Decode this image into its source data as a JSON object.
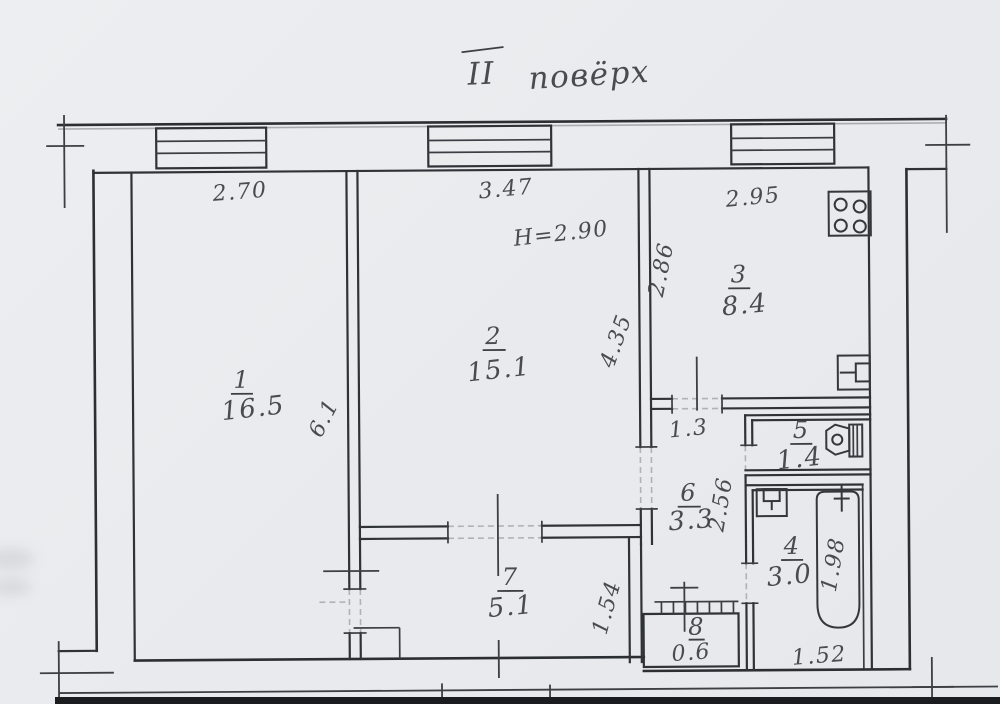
{
  "page": {
    "title_numeral": "ІІ",
    "title_word": "повёрх"
  },
  "rooms": {
    "r1": {
      "num": "1",
      "area": "16.5"
    },
    "r2": {
      "num": "2",
      "area": "15.1"
    },
    "r3": {
      "num": "3",
      "area": "8.4"
    },
    "r4": {
      "num": "4",
      "area": "3.0"
    },
    "r5": {
      "num": "5",
      "area": "1.4"
    },
    "r6": {
      "num": "6",
      "area": "3.3"
    },
    "r7": {
      "num": "7",
      "area": "5.1"
    },
    "r8": {
      "num": "8",
      "area": "0.6"
    }
  },
  "dims": {
    "room1_width": "2.70",
    "room1_depth": "6.1",
    "room2_width": "3.47",
    "room2_depth": "4.35",
    "ceiling_height": "H=2.90",
    "kitchen_width": "2.95",
    "kitchen_depth": "2.86",
    "hall_width": "1.3",
    "hall_depth": "2.56",
    "corridor_width": "1.54",
    "bath_width": "1.52",
    "bath_depth": "1.98"
  },
  "icons": {
    "stove": "stove-icon",
    "sink": "kitchen-sink-icon",
    "toilet": "toilet-icon",
    "washbasin": "washbasin-icon",
    "bathtub": "bathtub-icon"
  },
  "colors": {
    "paper": "#e9ebee",
    "ink": "#2f3236",
    "handwriting": "#3b3e43",
    "page_edge_band": "#1b1c1e"
  }
}
